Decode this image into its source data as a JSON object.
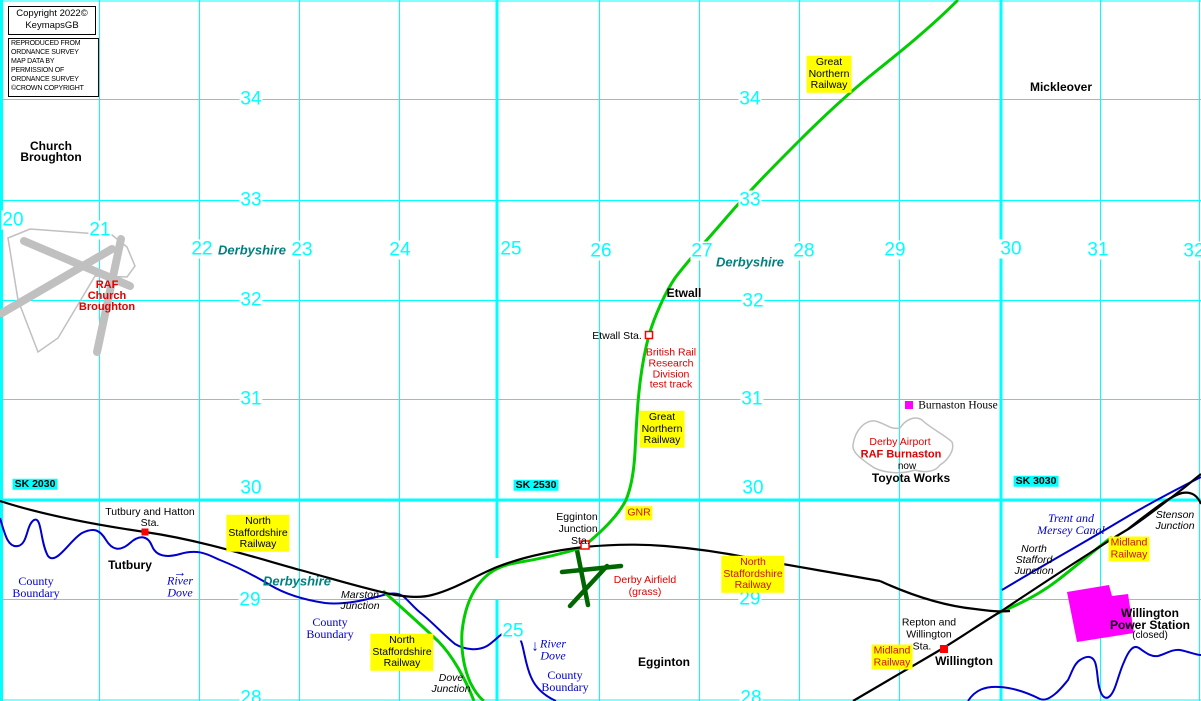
{
  "title": "KeymapsGB railway map - Etwall / Egginton / Willington area",
  "copyright": {
    "line1": "Copyright 2022©",
    "line2": "KeymapsGB",
    "notice": [
      "REPRODUCED FROM",
      "ORDNANCE SURVEY",
      "MAP DATA BY",
      "PERMISSION OF",
      "ORDNANCE SURVEY",
      "©CROWN COPYRIGHT"
    ]
  },
  "grid": {
    "eastings": [
      "20",
      "21",
      "22",
      "23",
      "24",
      "25",
      "26",
      "27",
      "28",
      "29",
      "30",
      "31",
      "32"
    ],
    "easting_bottom": "25",
    "northings_left": [
      "34",
      "33",
      "32",
      "31",
      "30",
      "29",
      "28"
    ],
    "northings_mid": [
      "34",
      "33",
      "32",
      "31",
      "30",
      "29",
      "28"
    ],
    "sk_labels": [
      "SK 2030",
      "SK 2530",
      "SK 3030"
    ]
  },
  "counties": {
    "derbyshire": "Derbyshire"
  },
  "places": {
    "church_broughton": [
      "Church",
      "Broughton"
    ],
    "mickleover": "Mickleover",
    "etwall": "Etwall",
    "tutbury": "Tutbury",
    "egginton": "Egginton",
    "willington": "Willington",
    "toyota_works": "Toyota Works",
    "now": "now",
    "power_station": [
      "Willington",
      "Power Station",
      "(closed)"
    ],
    "burnaston_house": "Burnaston House"
  },
  "stations": {
    "tutbury_hatton": [
      "Tutbury and Hatton",
      "Sta."
    ],
    "etwall_sta": "Etwall Sta.",
    "egginton_junction": [
      "Egginton",
      "Junction",
      "Sta."
    ],
    "repton_willington": [
      "Repton and",
      "Willington",
      "Sta."
    ]
  },
  "junctions": {
    "marston": [
      "Marston",
      "Junction"
    ],
    "dove": [
      "Dove",
      "Junction"
    ],
    "stenson": [
      "Stenson",
      "Junction"
    ],
    "north_stafford": [
      "North",
      "Stafford",
      "Junction"
    ]
  },
  "railways": {
    "gnr_top": [
      "Great",
      "Northern",
      "Railway"
    ],
    "gnr_etwall": [
      "Great",
      "Northern",
      "Railway"
    ],
    "gnr_short": "GNR",
    "nsr_tutbury": [
      "North",
      "Staffordshire",
      "Railway"
    ],
    "nsr_marston": [
      "North",
      "Staffordshire",
      "Railway"
    ],
    "nsr_willington": [
      "North",
      "Staffordshire",
      "Railway"
    ],
    "midland_stenson": [
      "Midland",
      "Railway"
    ],
    "midland_willington": [
      "Midland",
      "Railway"
    ]
  },
  "airfields": {
    "raf_church_broughton": [
      "RAF",
      "Church",
      "Broughton"
    ],
    "brr_test_track": [
      "British Rail",
      "Research",
      "Division",
      "test track"
    ],
    "derby_airport": "Derby Airport",
    "raf_burnaston": "RAF Burnaston",
    "derby_airfield": [
      "Derby Airfield",
      "(grass)"
    ]
  },
  "water": {
    "county_boundary": [
      "County",
      "Boundary"
    ],
    "river_dove": [
      "River",
      "Dove"
    ],
    "trent_mersey": [
      "Trent and",
      "Mersey Canal"
    ],
    "arrow_right": "→",
    "arrow_down": "↓"
  },
  "colors": {
    "grid": "#00FFFF",
    "railway_black": "#000000",
    "railway_green": "#00CC00",
    "runway_dark_green": "#006600",
    "water_blue": "#0000CC",
    "county_teal": "#007F7F",
    "label_red": "#E00000",
    "highlight_yellow": "#FFFF00",
    "power_station_magenta": "#FF00FF",
    "runway_grey": "#C0C0C0",
    "station_marker_red": "#FF0000"
  }
}
